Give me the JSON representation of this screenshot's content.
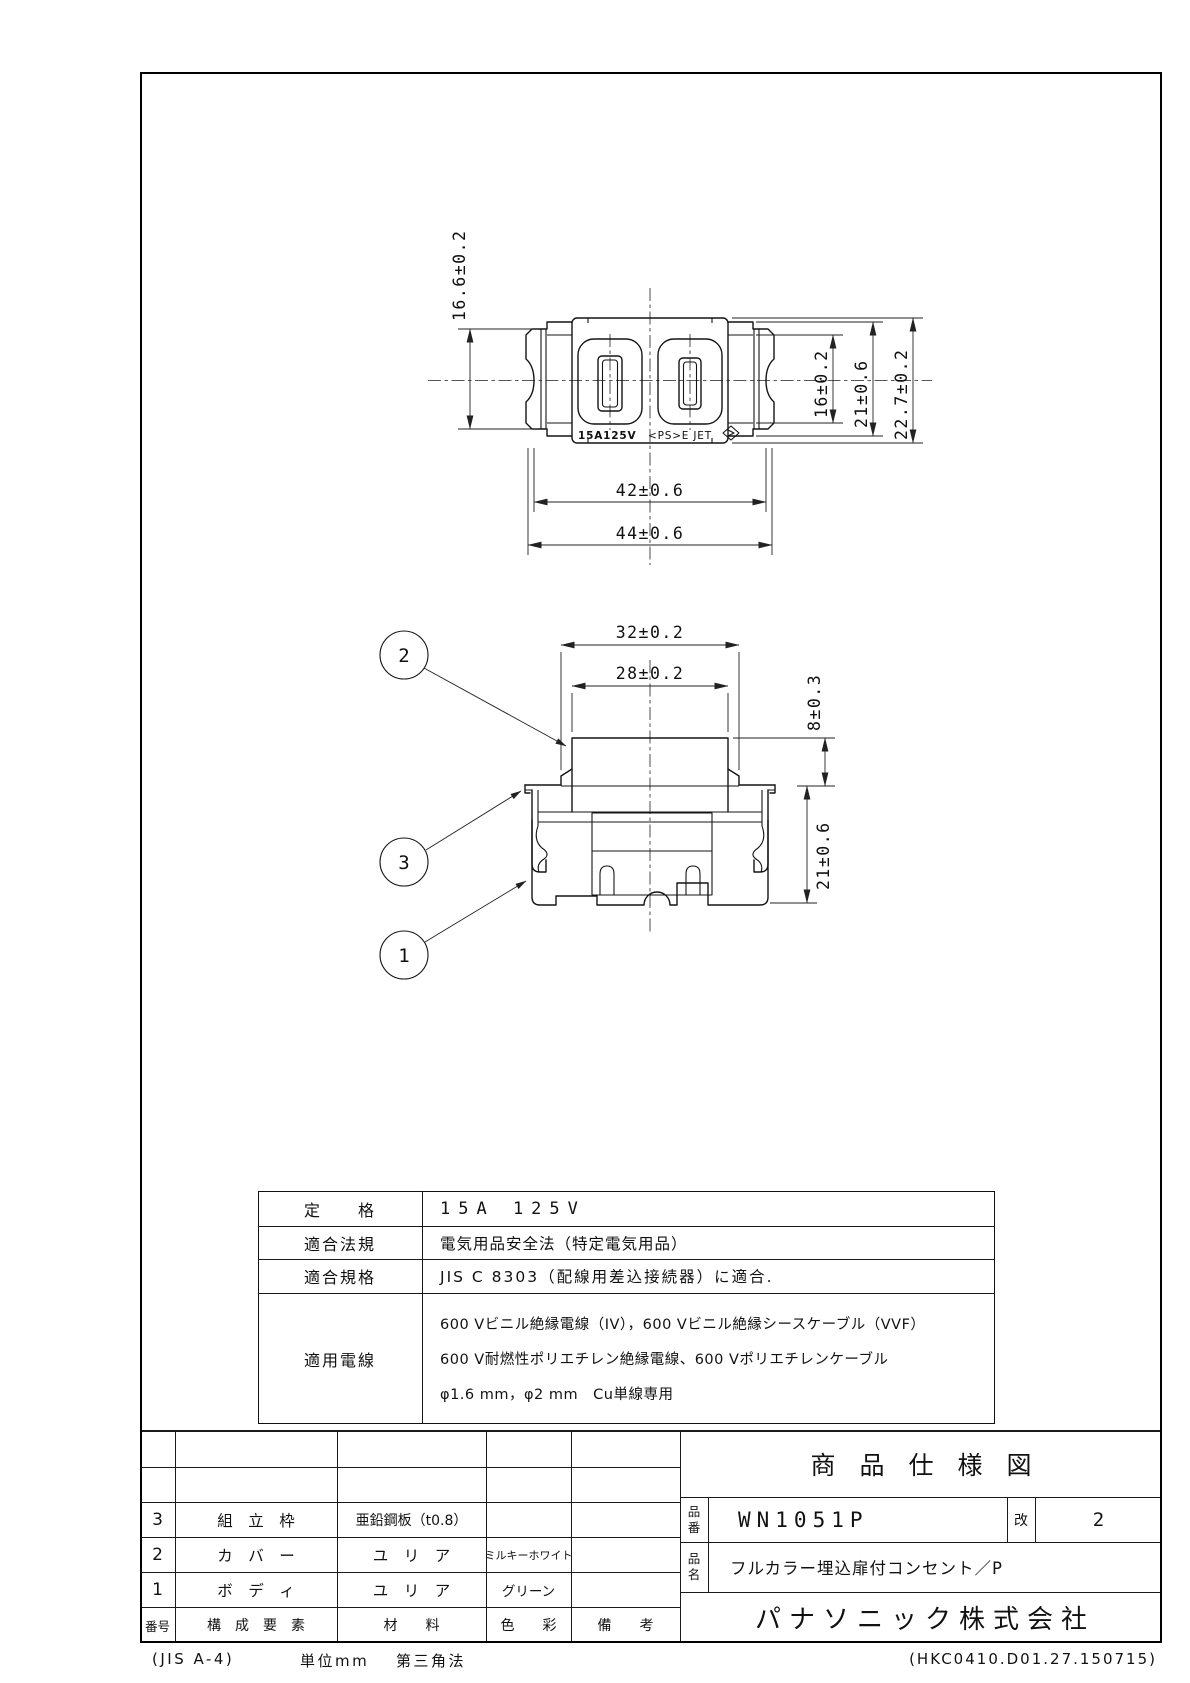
{
  "top_view": {
    "marking_rating": "15A125V",
    "marking_cert": "<PS>E JET",
    "dim_ear_height": "16.6±0.2",
    "dim_window_height": "16±0.2",
    "dim_frame_height": "21±0.6",
    "dim_face_height": "22.7±0.2",
    "dim_inner_width": "42±0.6",
    "dim_outer_width": "44±0.6"
  },
  "side_view": {
    "dim_flange_width": "32±0.2",
    "dim_cover_width": "28±0.2",
    "dim_cover_height": "8±0.3",
    "dim_body_height": "21±0.6",
    "balloon_cover": "2",
    "balloon_frame": "3",
    "balloon_body": "1"
  },
  "spec_table": {
    "rows": [
      {
        "label": "定　　格",
        "value": "15A 125V"
      },
      {
        "label": "適合法規",
        "value": "電気用品安全法（特定電気用品）"
      },
      {
        "label": "適合規格",
        "value": "JIS C 8303（配線用差込接続器）に適合."
      },
      {
        "label": "適用電線",
        "value_lines": [
          "600 Vビニル絶縁電線（IV），600 Vビニル絶縁シースケーブル（VVF）",
          "600 V耐燃性ポリエチレン絶縁電線、600 Vポリエチレンケーブル",
          "φ1.6 mm，φ2 mm　Cu単線専用"
        ]
      }
    ]
  },
  "parts_table": {
    "header": {
      "no": "番号",
      "component": "構　成　要　素",
      "material": "材　　料",
      "color": "色　　彩",
      "note": "備　　考"
    },
    "rows": [
      {
        "no": "3",
        "component": "組　立　枠",
        "material": "亜鉛鋼板（t0.8）",
        "color": "",
        "note": ""
      },
      {
        "no": "2",
        "component": "カ　バ　ー",
        "material": "ユ　リ　ア",
        "color": "ミルキーホワイト",
        "note": ""
      },
      {
        "no": "1",
        "component": "ボ　デ　ィ",
        "material": "ユ　リ　ア",
        "color": "グリーン",
        "note": ""
      }
    ]
  },
  "title_block": {
    "title": "商品仕様図",
    "part_no_label_top": "品",
    "part_no_label_bottom": "番",
    "part_no": "WN1051P",
    "rev_label": "改",
    "rev": "2",
    "name_label_top": "品",
    "name_label_bottom": "名",
    "product_name": "フルカラー埋込扉付コンセント／P",
    "company": "パナソニック株式会社"
  },
  "footer": {
    "paper": "(JIS A-4)",
    "unit": "単位mm",
    "projection": "第三角法",
    "doc_code": "(HKC0410.D01.27.150715)"
  }
}
